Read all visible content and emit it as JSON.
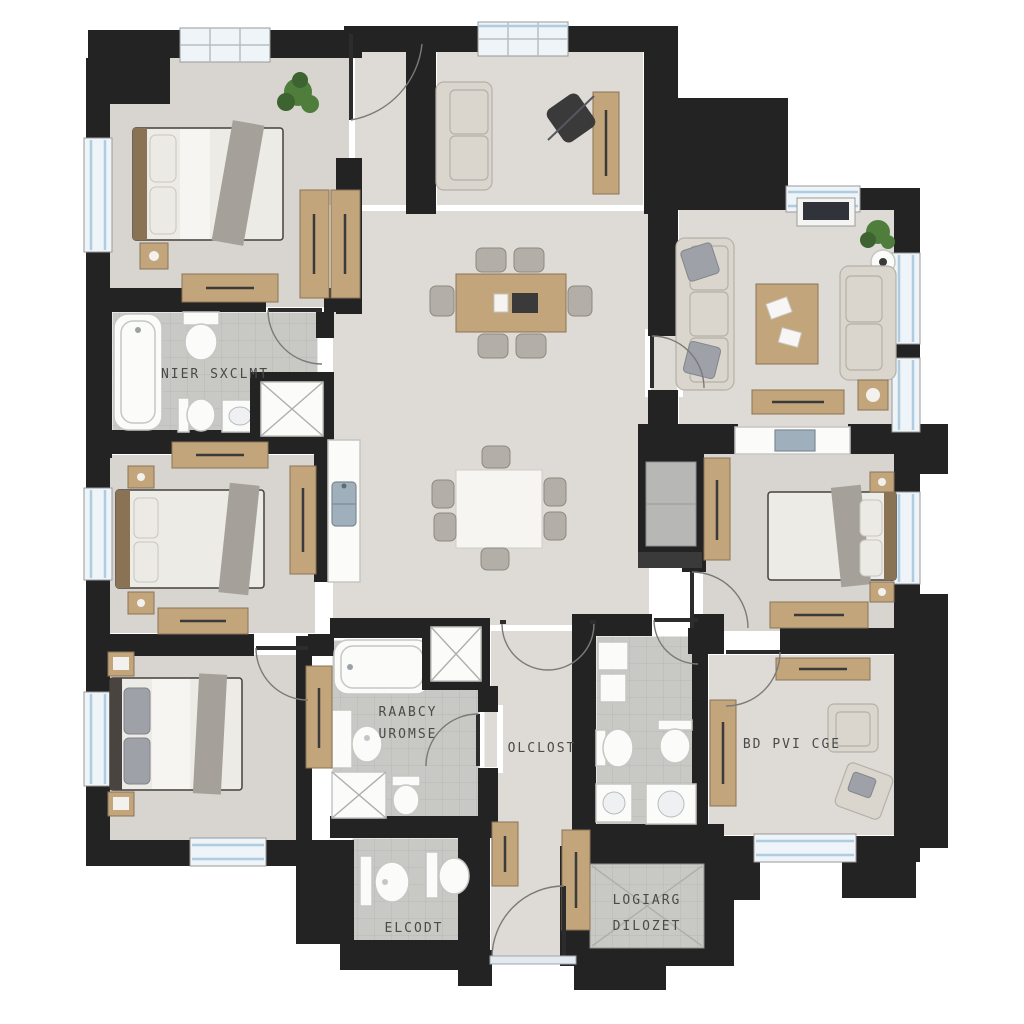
{
  "meta": {
    "kind": "apartment-floor-plan-render"
  },
  "colors": {
    "page_bg": "#ffffff",
    "wall": "#232323",
    "floor": "#dedbd6",
    "floor_alt": "#d8d5d0",
    "tile": "#c8c8c5",
    "tile_line": "#b7b7b4",
    "wood": "#c3a57b",
    "wood_dark": "#8a7355",
    "fabric": "#dad6cd",
    "fabric_line": "#b5b1a8",
    "pillow_gray": "#9fa1a8",
    "mattress": "#edebe6",
    "white_fixture": "#fbfbfa",
    "fixture_line": "#c6c6c3",
    "runner": "#a5a19a",
    "window_blue": "#aecde2",
    "glass": "#eef4f8",
    "label": "#4a4a47",
    "plant": "#4f7d3c",
    "plant_dark": "#3c6330",
    "steel": "#9fb0bc",
    "dark_item": "#3a3a3a",
    "chair_gray": "#b3afa8",
    "tv": "#30343a"
  },
  "labels": {
    "bathroom_top": "NIER SXCLMT",
    "bathroom_mid_line1": "RAABCY",
    "bathroom_mid_line2": "UROMSE",
    "hall": "OLCLOST",
    "office": "BD PVI CGE",
    "bathroom_bottom": "ELCODT",
    "closet_line1": "LOGIARG",
    "closet_line2": "DILOZET"
  }
}
